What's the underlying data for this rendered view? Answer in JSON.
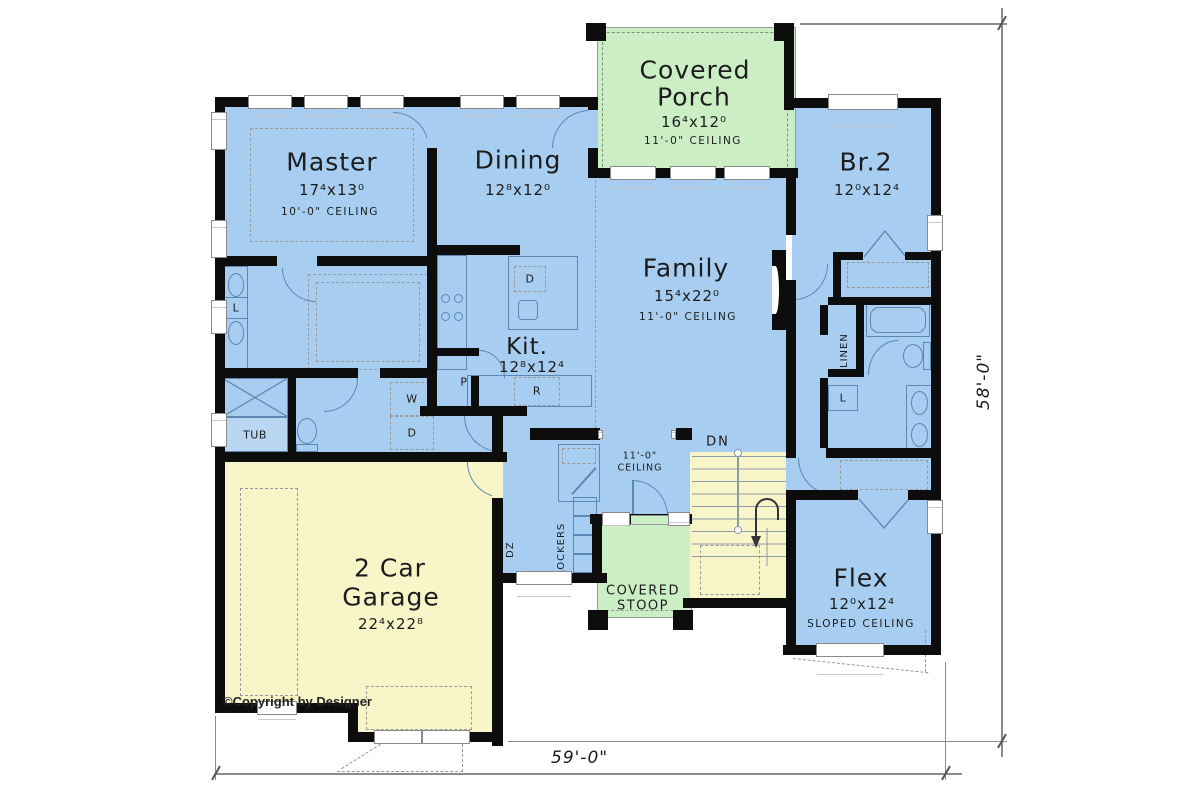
{
  "plan": {
    "rooms": {
      "porch": {
        "line1": "Covered",
        "line2": "Porch",
        "size": "16⁴x12⁰",
        "ceiling": "11'-0\" CEILING"
      },
      "master": {
        "name": "Master",
        "size": "17⁴x13⁰",
        "ceiling": "10'-0\" CEILING"
      },
      "dining": {
        "name": "Dining",
        "size": "12⁸x12⁰"
      },
      "family": {
        "name": "Family",
        "size": "15⁴x22⁰",
        "ceiling": "11'-0\" CEILING"
      },
      "kitchen": {
        "name": "Kit.",
        "size": "12⁸x12⁴"
      },
      "br2": {
        "name": "Br.2",
        "size": "12⁰x12⁴"
      },
      "flex": {
        "name": "Flex",
        "size": "12⁰x12⁴",
        "ceiling": "SLOPED CEILING"
      },
      "garage": {
        "line1": "2 Car",
        "line2": "Garage",
        "size": "22⁴x22⁸"
      },
      "stoop": {
        "line1": "COVERED",
        "line2": "STOOP"
      },
      "entry": {
        "ceiling_line1": "11'-0\"",
        "ceiling_line2": "CEILING"
      }
    },
    "fixtures": {
      "tub": "TUB",
      "washer": "W",
      "dryer": "D",
      "dishwasher": "D",
      "pantry": "P",
      "range": "R",
      "linen": "LINEN",
      "linen_short": "L",
      "closet_l": "L",
      "lockers": "LOCKERS",
      "drop_zone": "DZ",
      "stairs_down": "DN"
    },
    "dimensions": {
      "width": "59'-0\"",
      "depth": "58'-0\""
    },
    "copyright": "©Copyright by Designer",
    "colors": {
      "room_blue": "#a7cdf0",
      "porch_green": "#cbeec5",
      "garage_yellow": "#f8f5c8",
      "wall": "#0d0d0d",
      "fixture_line": "#5e86b2"
    }
  }
}
